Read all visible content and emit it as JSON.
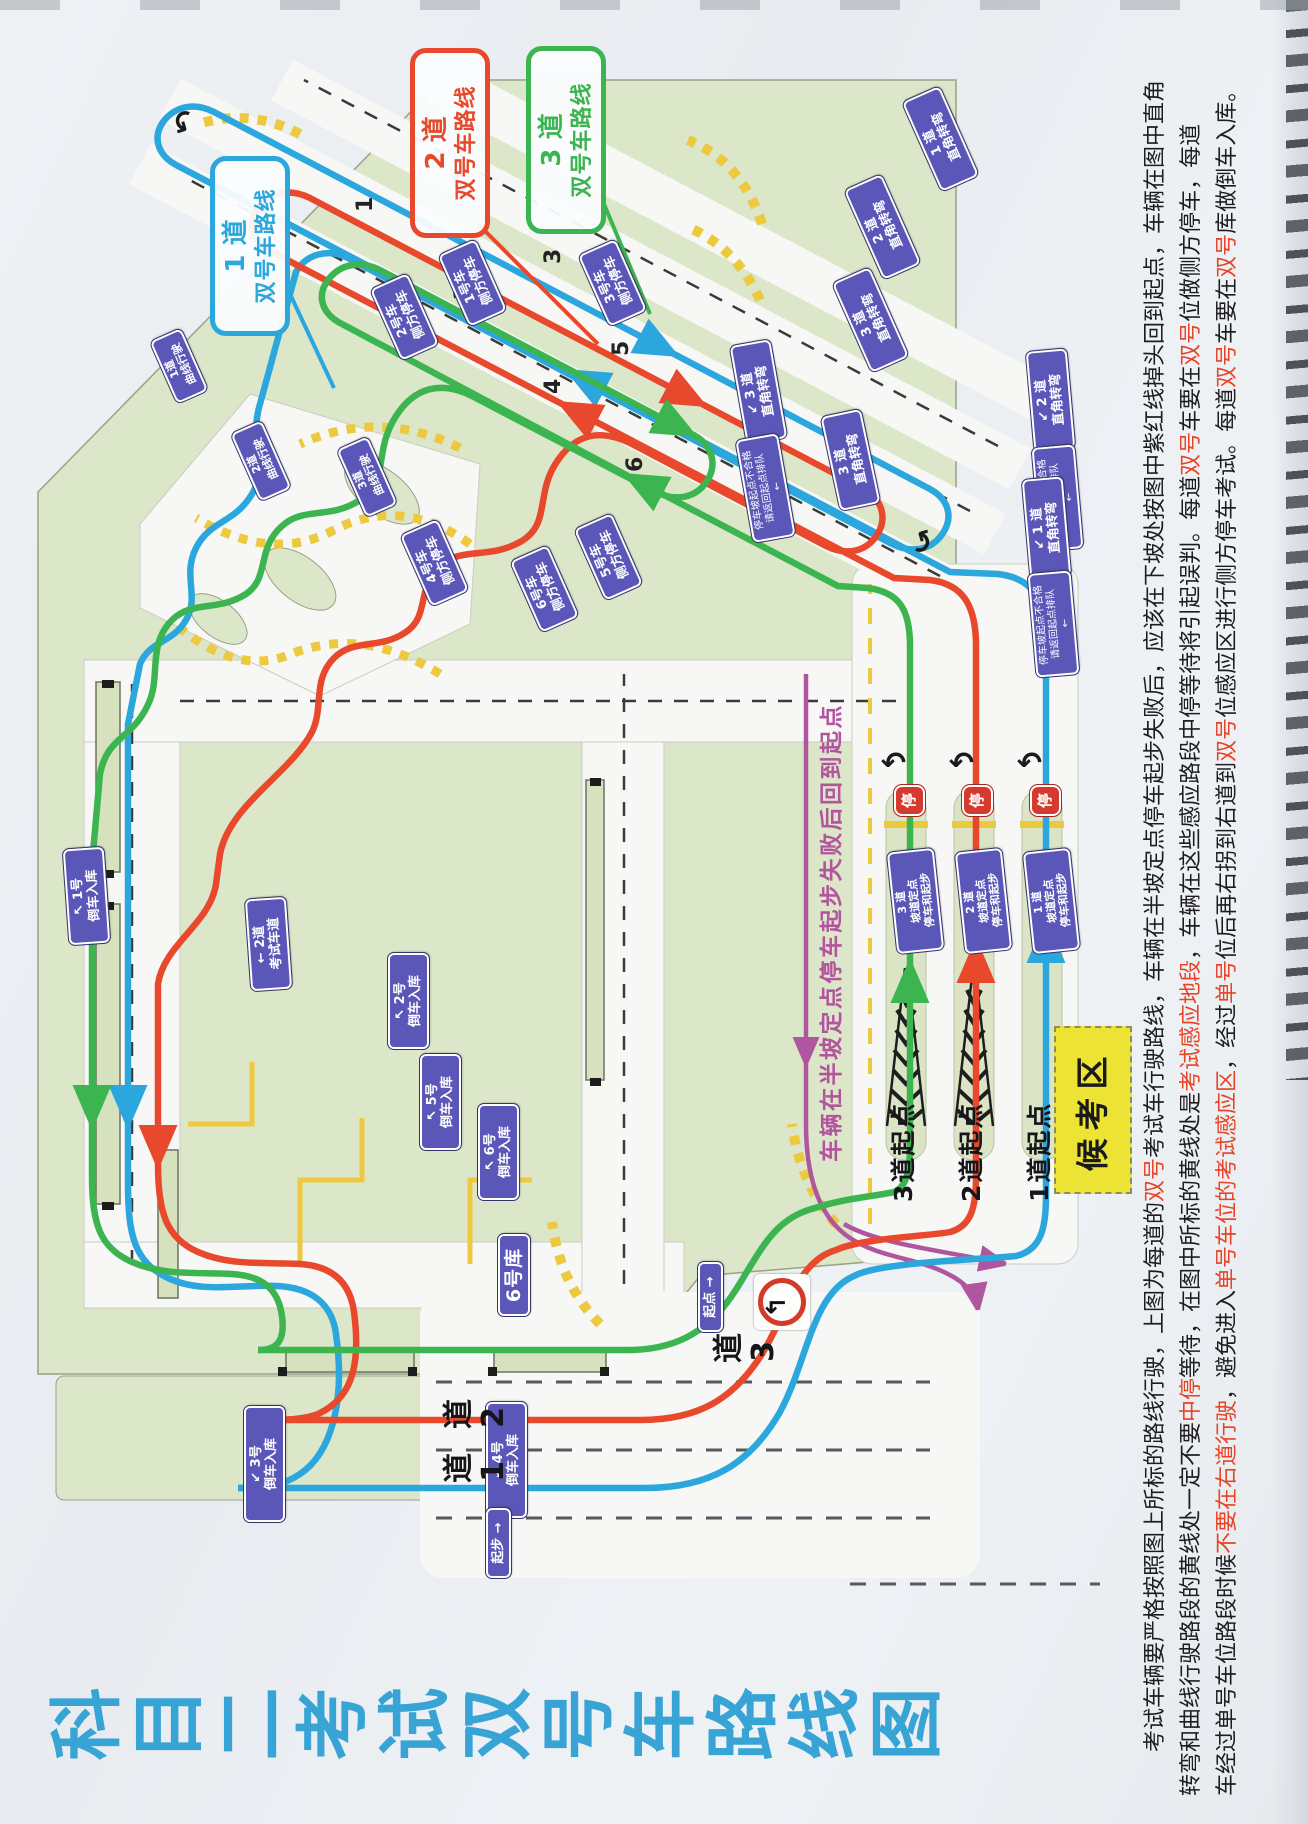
{
  "title": "科目二考试双号车路线图",
  "legend_callouts": [
    {
      "lane": "1 道",
      "label": "双号车路线",
      "color": "#2ba7dd"
    },
    {
      "lane": "2 道",
      "label": "双号车路线",
      "color": "#e8492c"
    },
    {
      "lane": "3 道",
      "label": "双号车路线",
      "color": "#3cb551"
    }
  ],
  "route_colors": {
    "lane1": "#2ba7dd",
    "lane2": "#e8492c",
    "lane3": "#3cb551",
    "return": "#b0559f"
  },
  "waiting_area_label": "候考区",
  "purple_note": "车辆在半坡定点停车起步失败后回到起点",
  "stop_sign": "停",
  "lane_start_labels": [
    "3道起点",
    "2道起点",
    "1道起点"
  ],
  "lane_markers": [
    "道3",
    "道2",
    "道1"
  ],
  "bay_numbers": [
    "1",
    "2",
    "3",
    "4",
    "5",
    "6"
  ],
  "signs": [
    {
      "l1": "1 道",
      "l2": "直角转弯"
    },
    {
      "l1": "2 道",
      "l2": "直角转弯"
    },
    {
      "l1": "3 道",
      "l2": "直角转弯"
    },
    {
      "l1": "↙ 3 道",
      "l2": "直角转弯"
    },
    {
      "l1": "↙ 2 道",
      "l2": "直角转弯"
    },
    {
      "l1": "↙ 1 道",
      "l2": "直角转弯"
    },
    {
      "l1": "停车坡起点不合格",
      "l2": "请返回起点排队",
      "l3": "←"
    },
    {
      "l1": "停车坡起点不合格",
      "l2": "请返回起点排队",
      "l3": "←"
    },
    {
      "l1": "停车坡起点不合格",
      "l2": "请返回起点排队",
      "l3": "←"
    },
    {
      "l1": "3 道",
      "l2": "坡道定点",
      "l3": "停车和起步"
    },
    {
      "l1": "2 道",
      "l2": "坡道定点",
      "l3": "停车和起步"
    },
    {
      "l1": "1 道",
      "l2": "坡道定点",
      "l3": "停车和起步"
    },
    {
      "l1": "↖ 1号",
      "l2": "倒车入库"
    },
    {
      "l1": "↖ 2号",
      "l2": "倒车入库"
    },
    {
      "l1": "↙ 3号",
      "l2": "倒车入库"
    },
    {
      "l1": "↙ 4号",
      "l2": "倒车入库"
    },
    {
      "l1": "↖ 5号",
      "l2": "倒车入库"
    },
    {
      "l1": "↖ 6号",
      "l2": "倒车入库"
    },
    {
      "l1": "6号库"
    },
    {
      "l1": "← 2道",
      "l2": "考试车道"
    },
    {
      "l1": "1号车",
      "l2": "侧方停车"
    },
    {
      "l1": "2号车",
      "l2": "侧方停车"
    },
    {
      "l1": "3号车",
      "l2": "侧方停车"
    },
    {
      "l1": "4号车",
      "l2": "侧方停车"
    },
    {
      "l1": "5号车",
      "l2": "侧方停车"
    },
    {
      "l1": "6号车",
      "l2": "侧方停车"
    },
    {
      "l1": "1道",
      "l2": "曲线行驶"
    },
    {
      "l1": "2道",
      "l2": "曲线行驶"
    },
    {
      "l1": "3道",
      "l2": "曲线行驶"
    },
    {
      "l1": "起点 →"
    },
    {
      "l1": "起步 →"
    }
  ],
  "description": {
    "lines": [
      [
        {
          "t": "　　考试车辆要严格按照图上所标的路线行驶，上图为每道的"
        },
        {
          "t": "双号",
          "red": true
        },
        {
          "t": "考试车行驶路线，车辆在半坡定点停车起步失败后，应该在下坡处按图中紫红线掉头回到起点，车辆在图中直角"
        }
      ],
      [
        {
          "t": "转弯和曲线行驶路段的黄线处一定不要"
        },
        {
          "t": "中停",
          "red": true
        },
        {
          "t": "等待，在图中所标的黄线处是"
        },
        {
          "t": "考试感应地段",
          "red": true
        },
        {
          "t": "，车辆在这些感应路段中停等待将引起误判。每道"
        },
        {
          "t": "双号",
          "red": true
        },
        {
          "t": "车要在"
        },
        {
          "t": "双号",
          "red": true
        },
        {
          "t": "位做侧方停车，每道"
        }
      ],
      [
        {
          "t": "车经过单号车位路段时候"
        },
        {
          "t": "不要在右道行驶",
          "red": true
        },
        {
          "t": "，避免进入"
        },
        {
          "t": "单号车位的考试感应区",
          "red": true
        },
        {
          "t": "，经过"
        },
        {
          "t": "单号",
          "red": true
        },
        {
          "t": "位后再右拐到右道到"
        },
        {
          "t": "双号",
          "red": true
        },
        {
          "t": "位感应区进行侧方停车考试。每道"
        },
        {
          "t": "双号",
          "red": true
        },
        {
          "t": "车要在"
        },
        {
          "t": "双号",
          "red": true
        },
        {
          "t": "库做倒车入库。"
        }
      ]
    ]
  }
}
